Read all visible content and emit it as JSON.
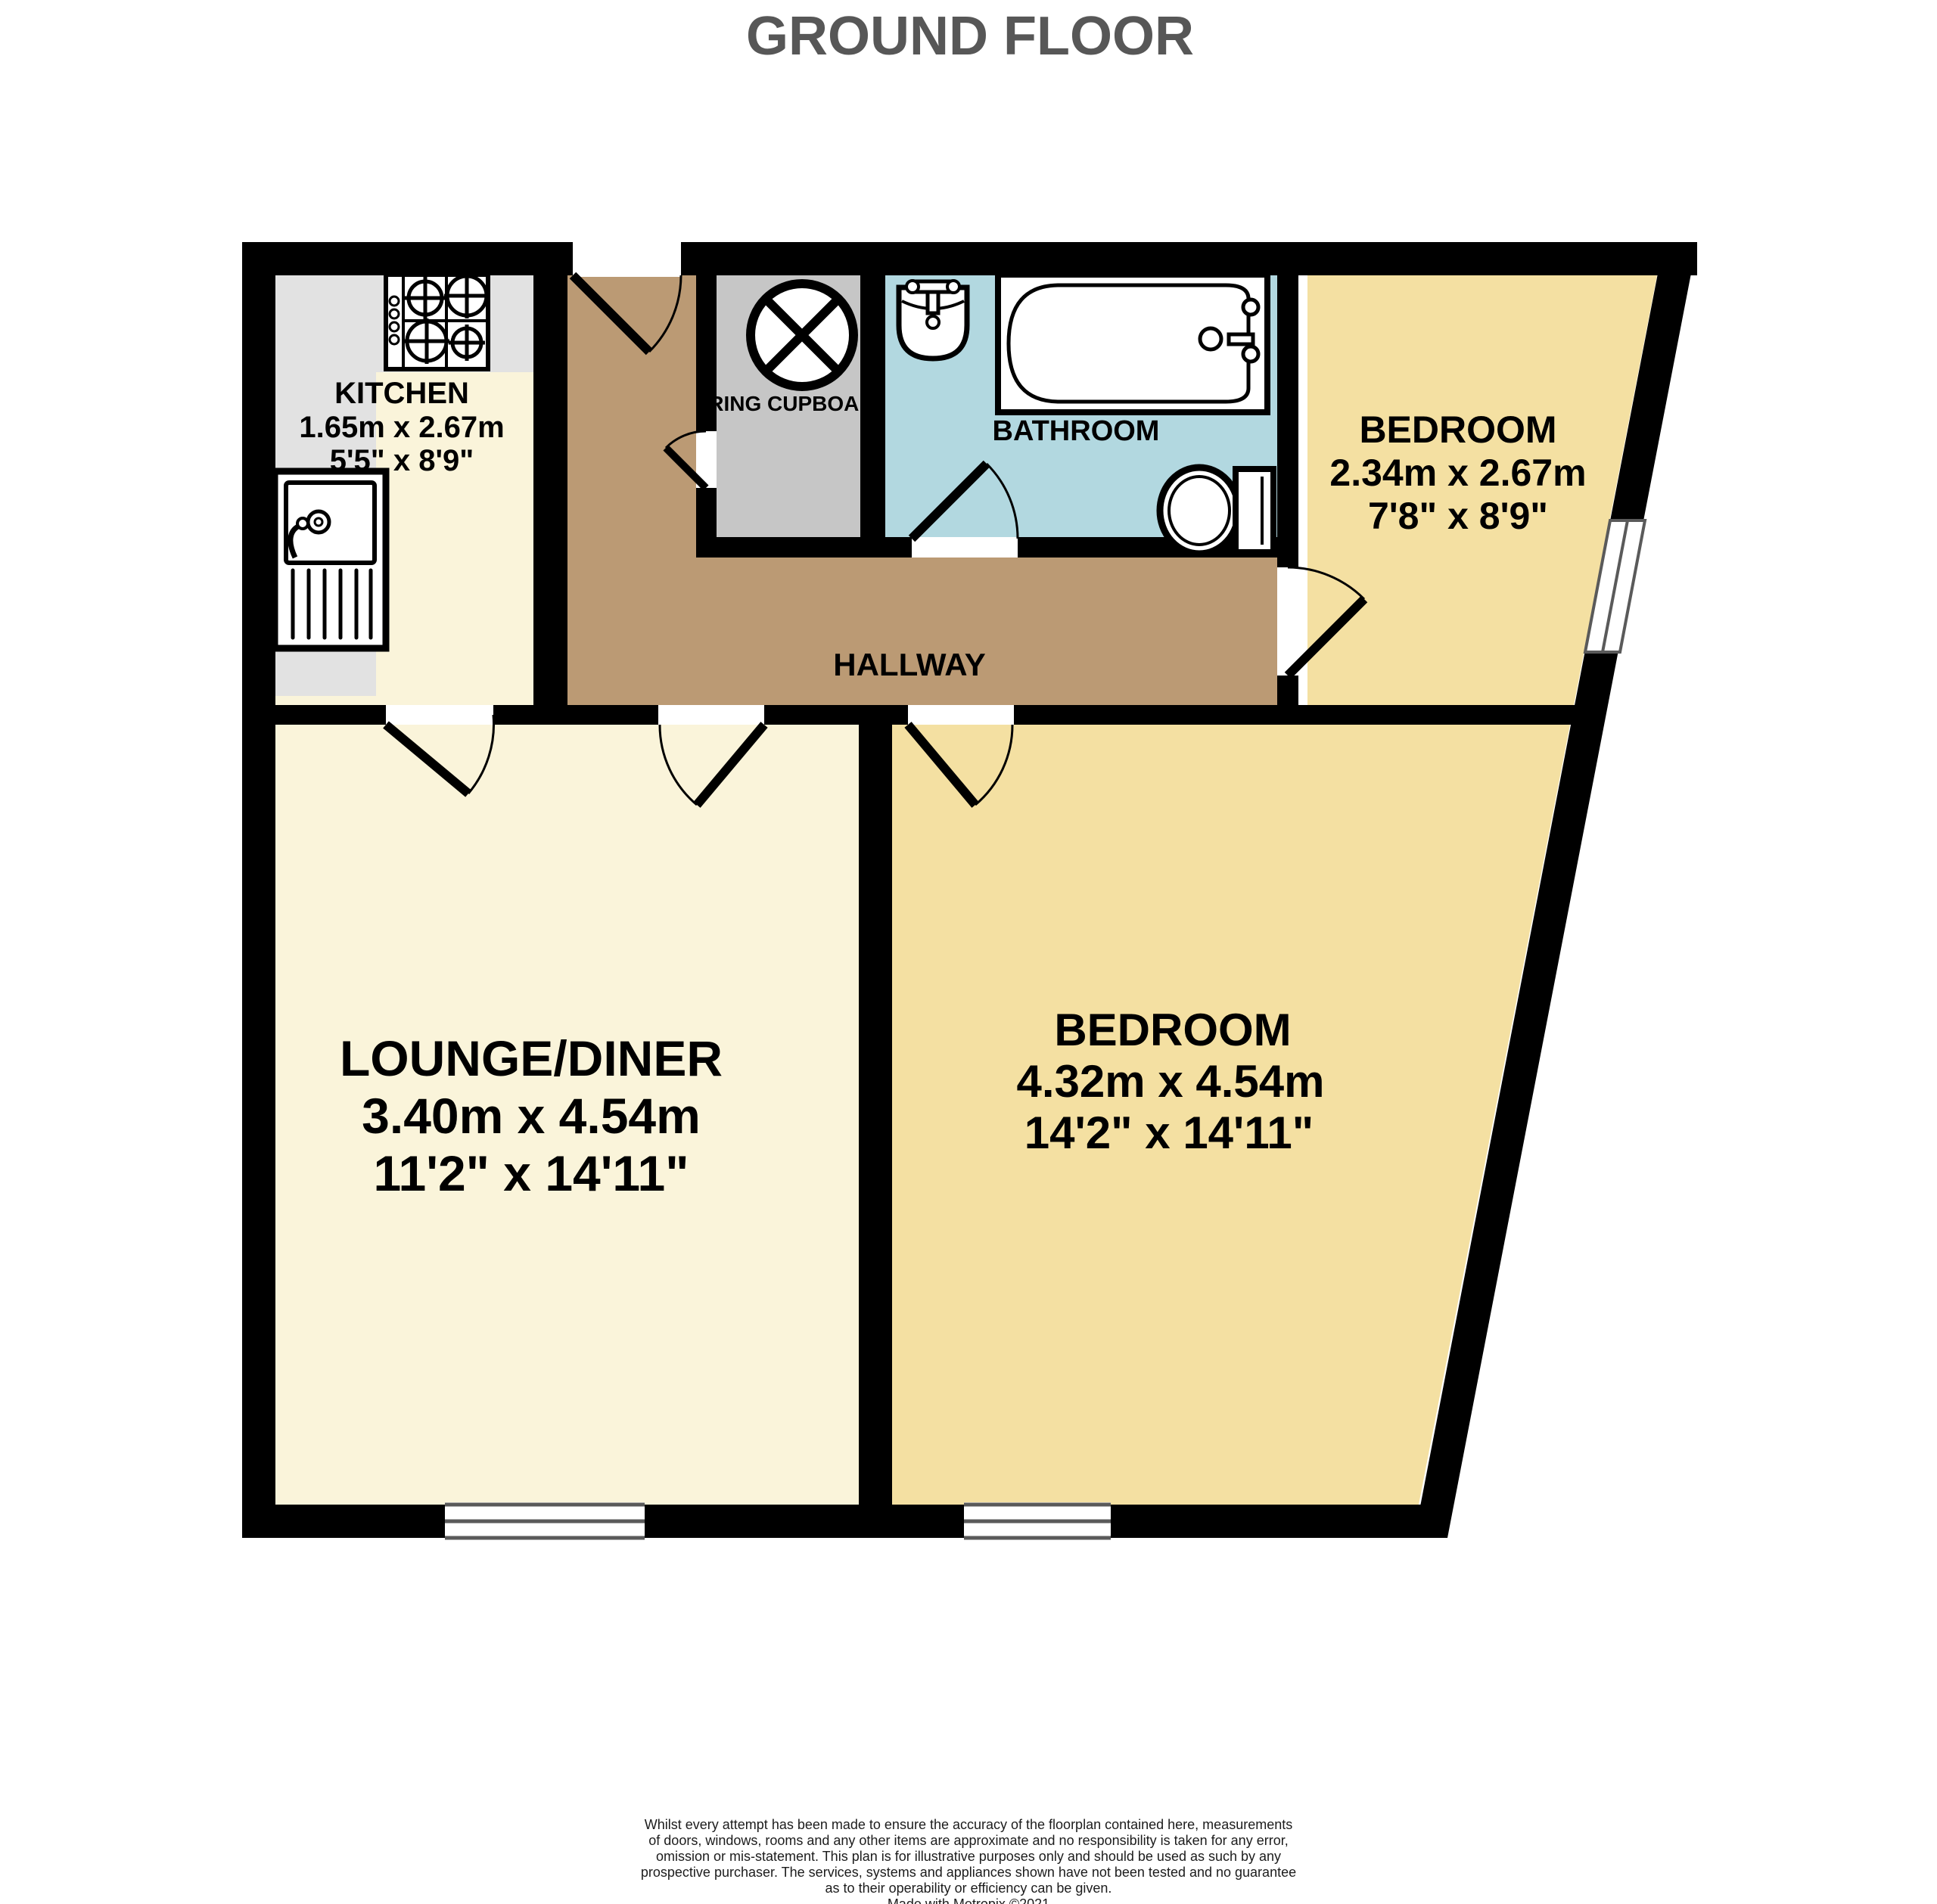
{
  "title": "GROUND FLOOR",
  "colors": {
    "wall": "#000000",
    "floor_cream": "#faf4da",
    "counter_grey": "#e2e2e2",
    "bedroom_yellow": "#f4e0a2",
    "hallway_tan": "#bb9a74",
    "bathroom_blue": "#b2d8e0",
    "cupboard_grey": "#c6c6c6",
    "window_line": "#5a5a5a"
  },
  "rooms": {
    "kitchen": {
      "name": "KITCHEN",
      "size_metric": "1.65m  x 2.67m",
      "size_imperial": "5'5\"  x 8'9\""
    },
    "airing_cupboard": {
      "name": "AIRING CUPBOARD"
    },
    "bathroom": {
      "name": "BATHROOM"
    },
    "hallway": {
      "name": "HALLWAY"
    },
    "bedroom_top": {
      "name": "BEDROOM",
      "size_metric": "2.34m  x 2.67m",
      "size_imperial": "7'8\"  x 8'9\""
    },
    "lounge_diner": {
      "name": "LOUNGE/DINER",
      "size_metric": "3.40m  x 4.54m",
      "size_imperial": "11'2\"  x 14'11\""
    },
    "bedroom_main": {
      "name": "BEDROOM",
      "size_metric": "4.32m  x 4.54m",
      "size_imperial": "14'2\"  x 14'11\""
    }
  },
  "fixtures": [
    "hob",
    "kitchen-sink",
    "hot-water-cylinder",
    "wash-basin",
    "bath",
    "toilet"
  ],
  "disclaimer": {
    "lines": [
      "Whilst every attempt has been made to ensure the accuracy of the floorplan contained here, measurements",
      "of doors, windows, rooms and any other items are approximate and no responsibility is taken for any error,",
      "omission or mis-statement. This plan is for illustrative purposes only and should be used as such by any",
      "prospective purchaser. The services, systems and appliances shown have not been tested and no guarantee",
      "as to their operability or efficiency can be given.",
      "Made with Metropix ©2021"
    ]
  }
}
